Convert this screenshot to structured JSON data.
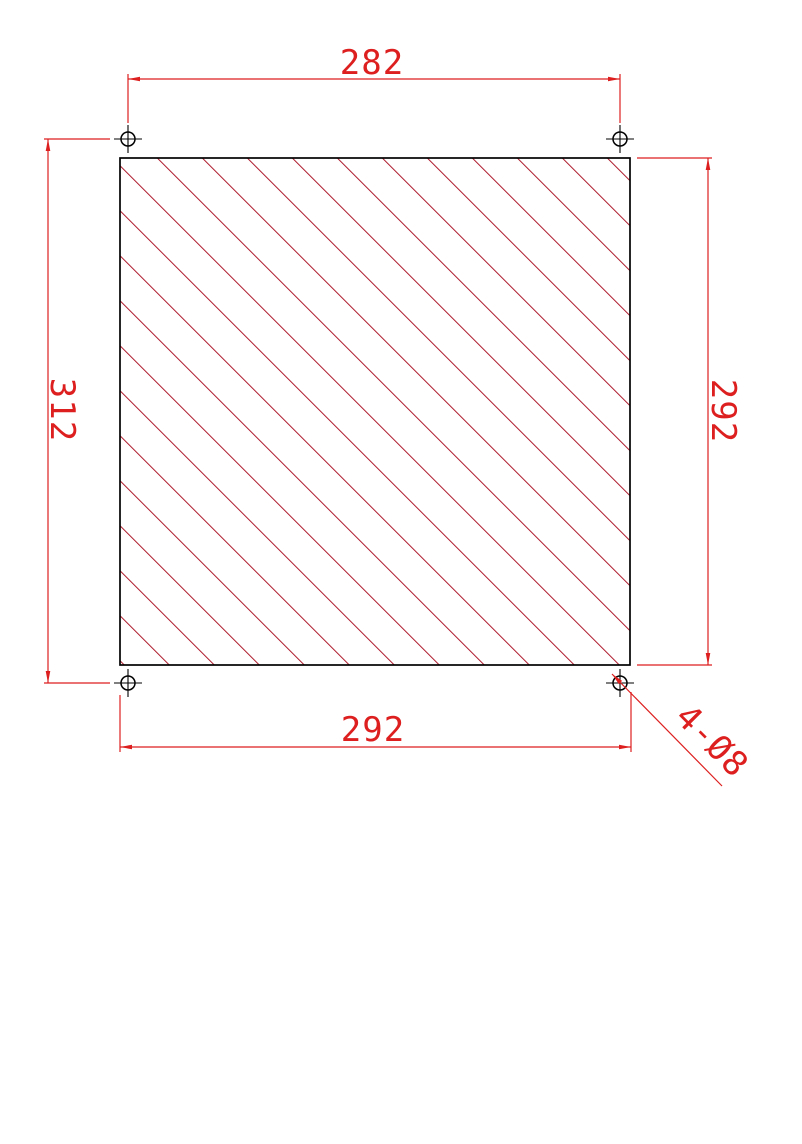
{
  "drawing": {
    "type": "mechanical-part-drawing",
    "part": "square hatched panel with 4 corner mounting holes",
    "dimensions": {
      "top_hole_spacing": "282",
      "left_hole_spacing": "312",
      "right_panel_height": "292",
      "bottom_panel_width": "292"
    },
    "leader": {
      "label": "4-Ø8"
    }
  },
  "colors": {
    "background": "#ffffff",
    "outline": "#000000",
    "dimension": "#dd1f1f",
    "hatch": "#b01f30"
  }
}
